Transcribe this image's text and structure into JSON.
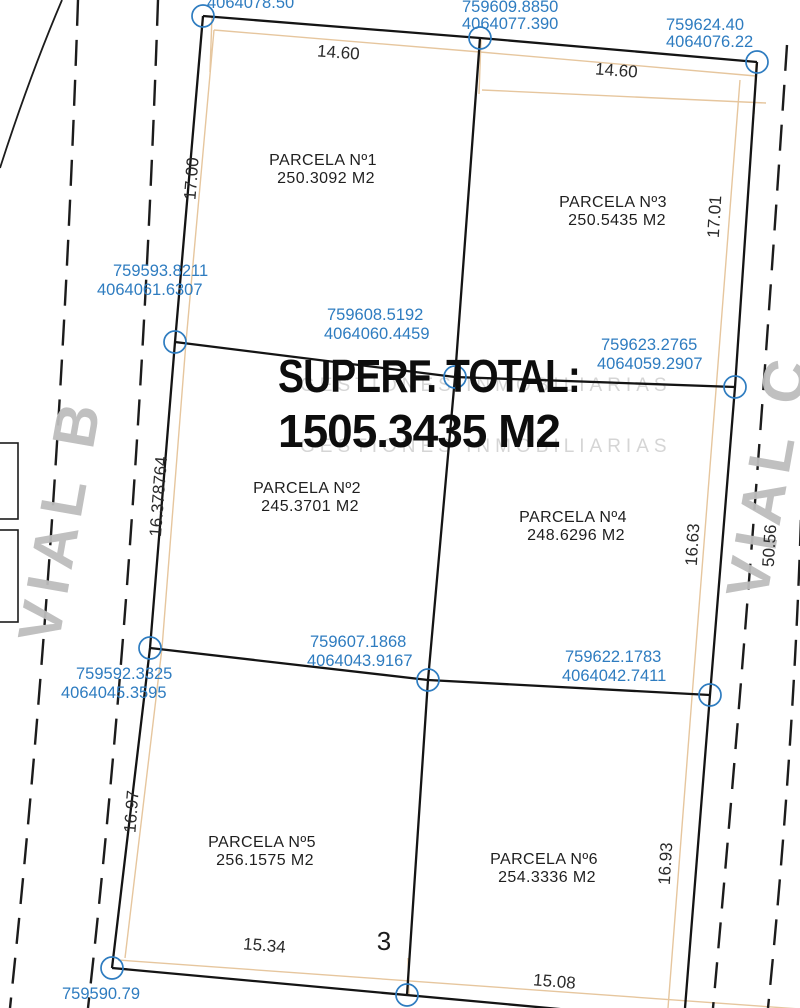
{
  "plan": {
    "total_label": "SUPERF. TOTAL:",
    "total_value": "1505.3435 M2",
    "watermark": "GESTIONES INMOBILIARIAS",
    "sheet_number": "3",
    "roads": {
      "left": "VIAL B",
      "right": "VIAL C"
    },
    "parcels": [
      {
        "name": "PARCELA Nº1",
        "area": "250.3092 M2"
      },
      {
        "name": "PARCELA Nº2",
        "area": "245.3701 M2"
      },
      {
        "name": "PARCELA Nº3",
        "area": "250.5435 M2"
      },
      {
        "name": "PARCELA Nº4",
        "area": "248.6296 M2"
      },
      {
        "name": "PARCELA Nº5",
        "area": "256.1575 M2"
      },
      {
        "name": "PARCELA Nº6",
        "area": "254.3336 M2"
      }
    ],
    "vertices": [
      {
        "id": "top-left",
        "easting": "",
        "northing": "4064078.50"
      },
      {
        "id": "top-middle",
        "easting": "759609.8850",
        "northing": "4064077.390"
      },
      {
        "id": "top-right",
        "easting": "759624.40",
        "northing": "4064076.22"
      },
      {
        "id": "mid-left",
        "easting": "759593.8211",
        "northing": "4064061.6307"
      },
      {
        "id": "mid-center",
        "easting": "759608.5192",
        "northing": "4064060.4459"
      },
      {
        "id": "mid-right",
        "easting": "759623.2765",
        "northing": "4064059.2907"
      },
      {
        "id": "lower-left",
        "easting": "759592.3325",
        "northing": "4064045.3595"
      },
      {
        "id": "lower-center",
        "easting": "759607.1868",
        "northing": "4064043.9167"
      },
      {
        "id": "lower-right",
        "easting": "759622.1783",
        "northing": "4064042.7411"
      },
      {
        "id": "bottom-left",
        "easting": "759590.79",
        "northing": ""
      }
    ],
    "dimensions": {
      "top_left_width": "14.60",
      "top_right_width": "14.60",
      "left_row1": "17.00",
      "right_row1": "17.01",
      "left_row2": "16.378764",
      "right_row2": "16.63",
      "right_road_width": "50.56",
      "left_row3": "16.97",
      "right_row3": "16.93",
      "bottom_left_width": "15.34",
      "bottom_right_width": "15.08"
    },
    "colors": {
      "coordinate_blue": "#2e7cc0",
      "construction_tan": "#e6c69e",
      "road_gray": "#bdbdbd",
      "line_black": "#141414"
    }
  }
}
